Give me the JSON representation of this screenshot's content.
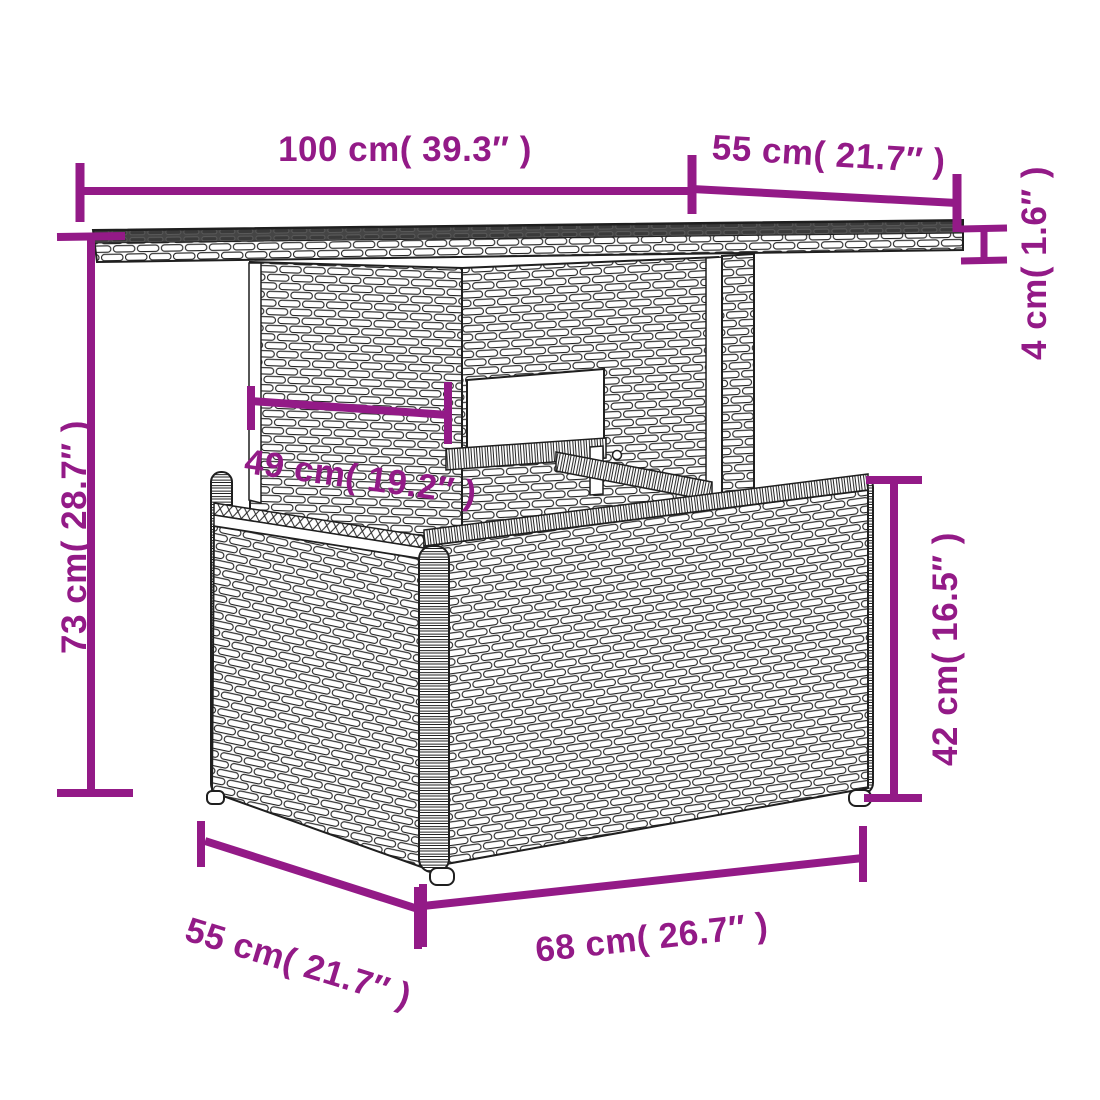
{
  "diagram": {
    "subject": "Poly rattan garden table dimension drawing",
    "background_color": "#ffffff",
    "accent_color": "#931A87",
    "line_art_color": "#1f1f1f",
    "tabletop_surface_color": "#454545"
  },
  "dims": {
    "top_width": {
      "cm": "100",
      "in": "39.3",
      "label": "100 cm( 39.3″ )"
    },
    "top_depth": {
      "cm": "55",
      "in": "21.7",
      "label": "55 cm( 21.7″ )"
    },
    "top_thickness": {
      "cm": "4",
      "in": "1.6",
      "label": "4 cm( 1.6″ )"
    },
    "overall_height": {
      "cm": "73",
      "in": "28.7",
      "label": "73 cm( 28.7″ )"
    },
    "pedestal_width": {
      "cm": "49",
      "in": "19.2",
      "label": "49 cm( 19.2″ )"
    },
    "base_height": {
      "cm": "42",
      "in": "16.5",
      "label": "42 cm( 16.5″ )"
    },
    "base_width": {
      "cm": "68",
      "in": "26.7",
      "label": "68 cm( 26.7″ )"
    },
    "base_depth": {
      "cm": "55",
      "in": "21.7",
      "label": "55 cm( 21.7″ )"
    }
  }
}
